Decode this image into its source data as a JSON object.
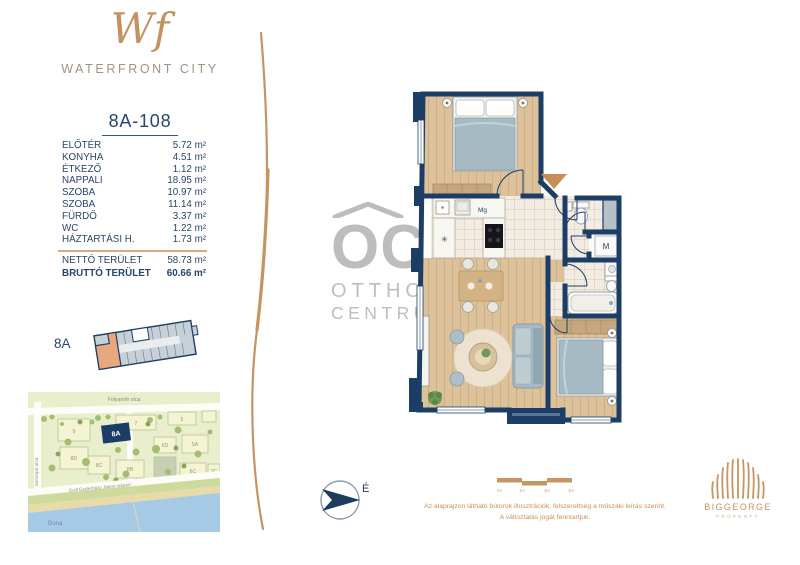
{
  "brand": {
    "monogram": "Wf",
    "name": "WATERFRONT CITY"
  },
  "unit": {
    "id": "8A-108",
    "rooms": [
      {
        "label": "ELŐTÉR",
        "area": "5.72 m²"
      },
      {
        "label": "KONYHA",
        "area": "4.51 m²"
      },
      {
        "label": "ÉTKEZŐ",
        "area": "1.12 m²"
      },
      {
        "label": "NAPPALI",
        "area": "18.95 m²"
      },
      {
        "label": "SZOBA",
        "area": "10.97 m²"
      },
      {
        "label": "SZOBA",
        "area": "11.14 m²"
      },
      {
        "label": "FÜRDŐ",
        "area": "3.37 m²"
      },
      {
        "label": "WC",
        "area": "1.22 m²"
      },
      {
        "label": "HÁZTARTÁSI H.",
        "area": "1.73 m²"
      }
    ],
    "net": {
      "label": "NETTÓ TERÜLET",
      "area": "58.73 m²"
    },
    "gross": {
      "label": "BRUTTÓ TERÜLET",
      "area": "60.66 m²"
    }
  },
  "building": {
    "key": "8A"
  },
  "floorplan": {
    "dishwasher": "Mg",
    "washer": "M",
    "fridge": "✳"
  },
  "watermark": {
    "monogram": "OC",
    "line1": "OTTHON",
    "line2": "CENTRUM"
  },
  "map": {
    "street_top": "Folyamőr utca",
    "street_left": "Sorompó utca",
    "street_river": "Gróf Eszterházy János rakpart",
    "river": "Duna",
    "highlight": "8A",
    "blocks": [
      "9",
      "7",
      "5",
      "6D",
      "5A",
      "8D",
      "8C",
      "8B",
      "6C",
      "3C"
    ]
  },
  "compass": {
    "north": "É"
  },
  "scalebar": {
    "t0": "0m",
    "t1": "1m",
    "t2": "2m",
    "t3": "3m"
  },
  "disclaimer": {
    "line1": "Az alaprajzon látható bútorok illusztrációk, felszereltség a műszaki leírás szerint.",
    "line2": "A változtatás jogát fenntartjuk."
  },
  "developer": {
    "name": "BIGGEORGE",
    "division": "PROPERTY"
  },
  "colors": {
    "navy": "#1c3e66",
    "tan": "#c79465",
    "wood": "#dcc19b",
    "tile": "#f2ece2",
    "furniture_gray": "#a5bac2",
    "watermark_gray": "#bdbdbd",
    "entry_arrow": "#c98d56",
    "map_green": "#e9eecd",
    "river_blue": "#a6c9e6"
  }
}
